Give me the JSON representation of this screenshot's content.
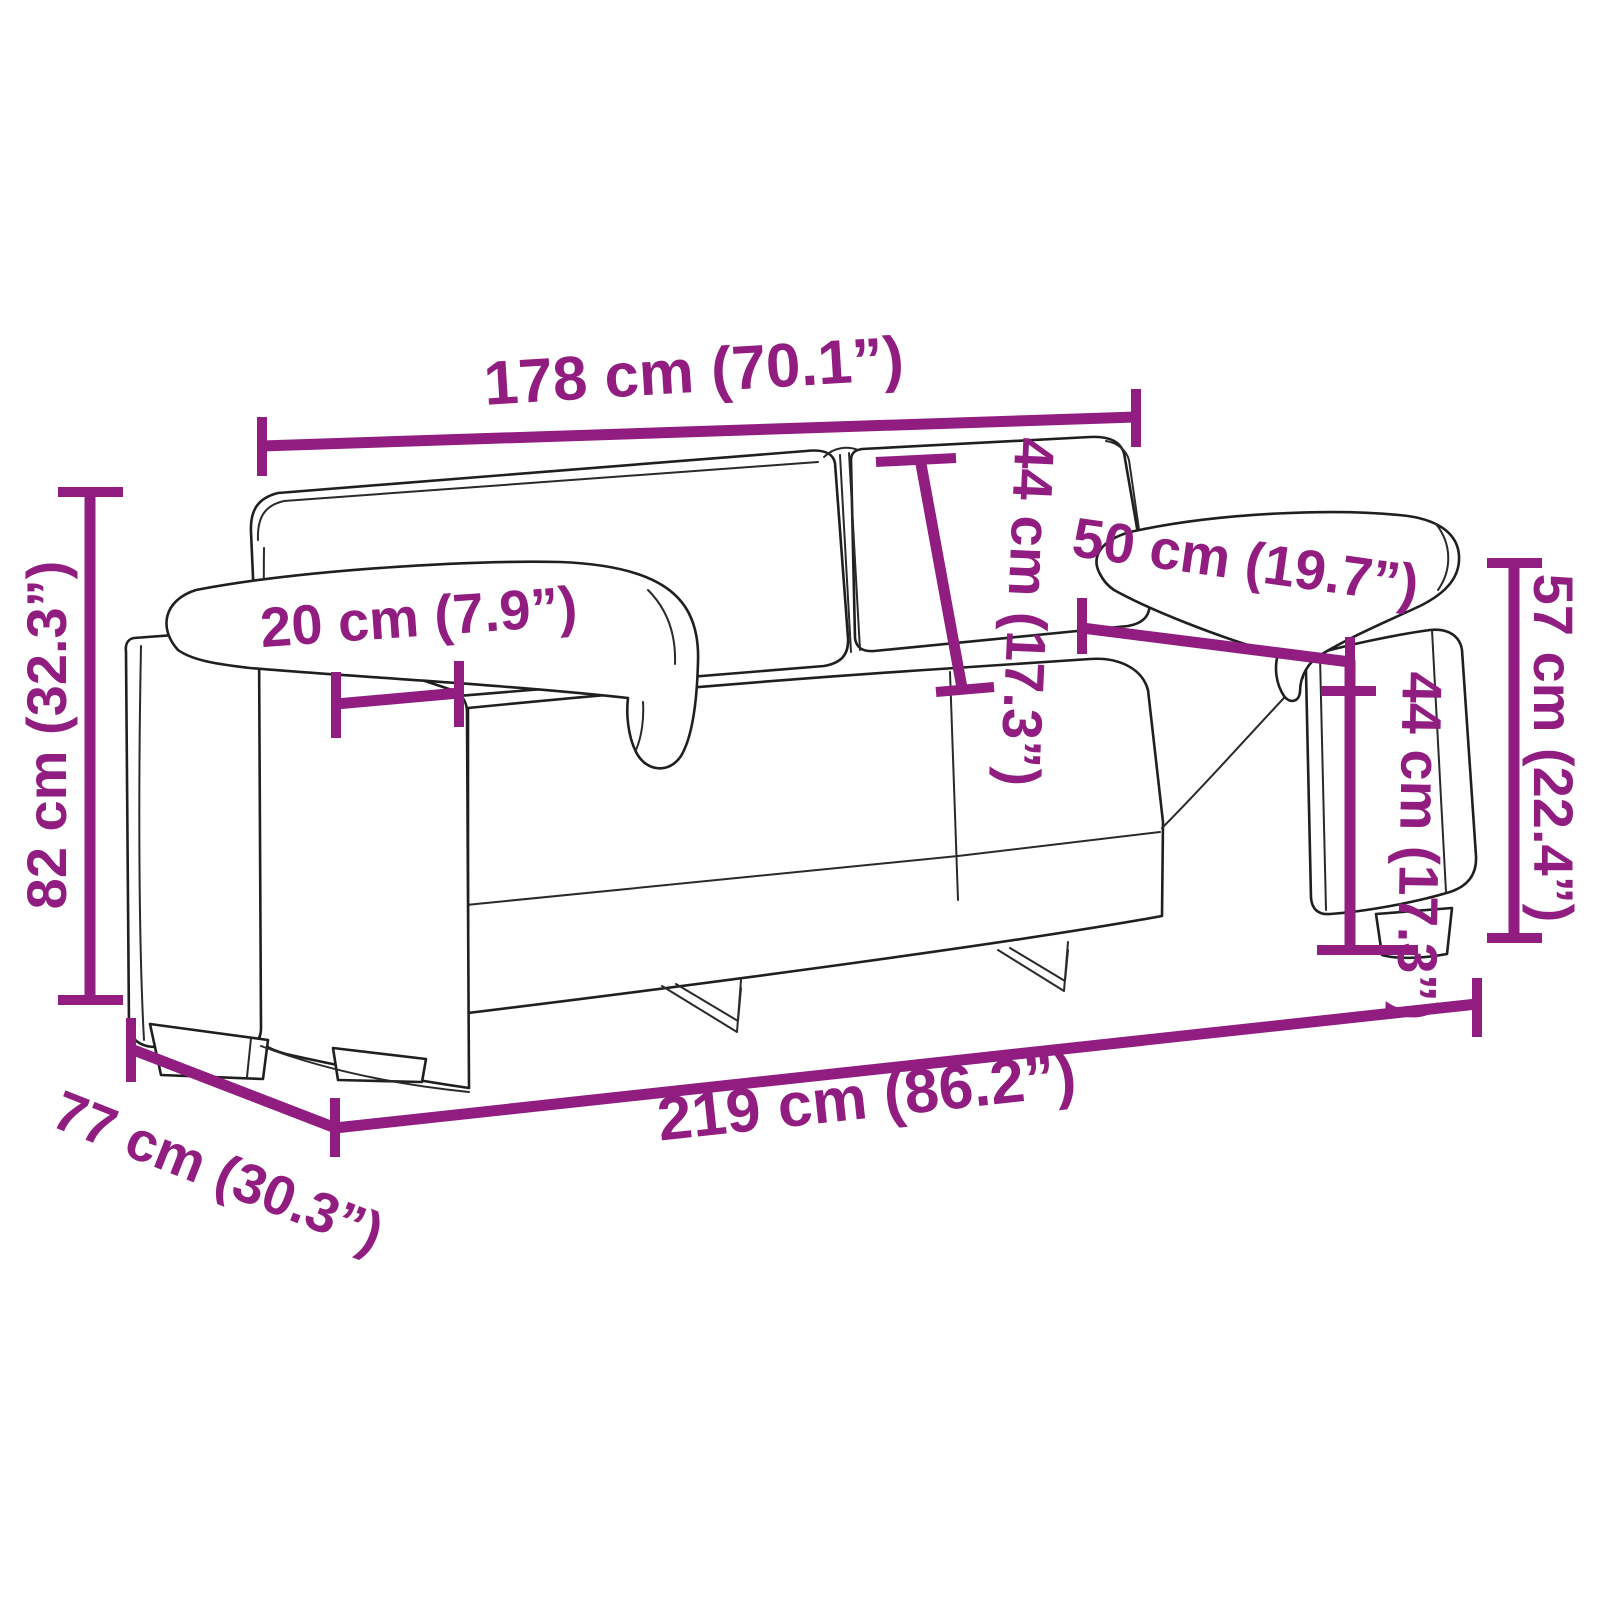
{
  "page": {
    "title": "Sofa dimension diagram",
    "background_color": "#ffffff"
  },
  "diagram": {
    "subject": "two-seater-sofa-line-drawing",
    "accent_color": "#911D81",
    "outline_color": "#1f1f1f",
    "dimensions": [
      {
        "id": "inner-width",
        "label": "178 cm (70.1”)"
      },
      {
        "id": "overall-height",
        "label": "82 cm (32.3”)"
      },
      {
        "id": "armrest-width",
        "label": "20 cm (7.9”)"
      },
      {
        "id": "backrest-height",
        "label": "44 cm (17.3”)"
      },
      {
        "id": "seat-depth",
        "label": "50 cm (19.7”)"
      },
      {
        "id": "armrest-height",
        "label": "57 cm (22.4”)"
      },
      {
        "id": "seat-height",
        "label": "44 cm (17.3”)"
      },
      {
        "id": "overall-width",
        "label": "219 cm (86.2”)"
      },
      {
        "id": "overall-depth",
        "label": "77 cm (30.3”)"
      }
    ]
  }
}
